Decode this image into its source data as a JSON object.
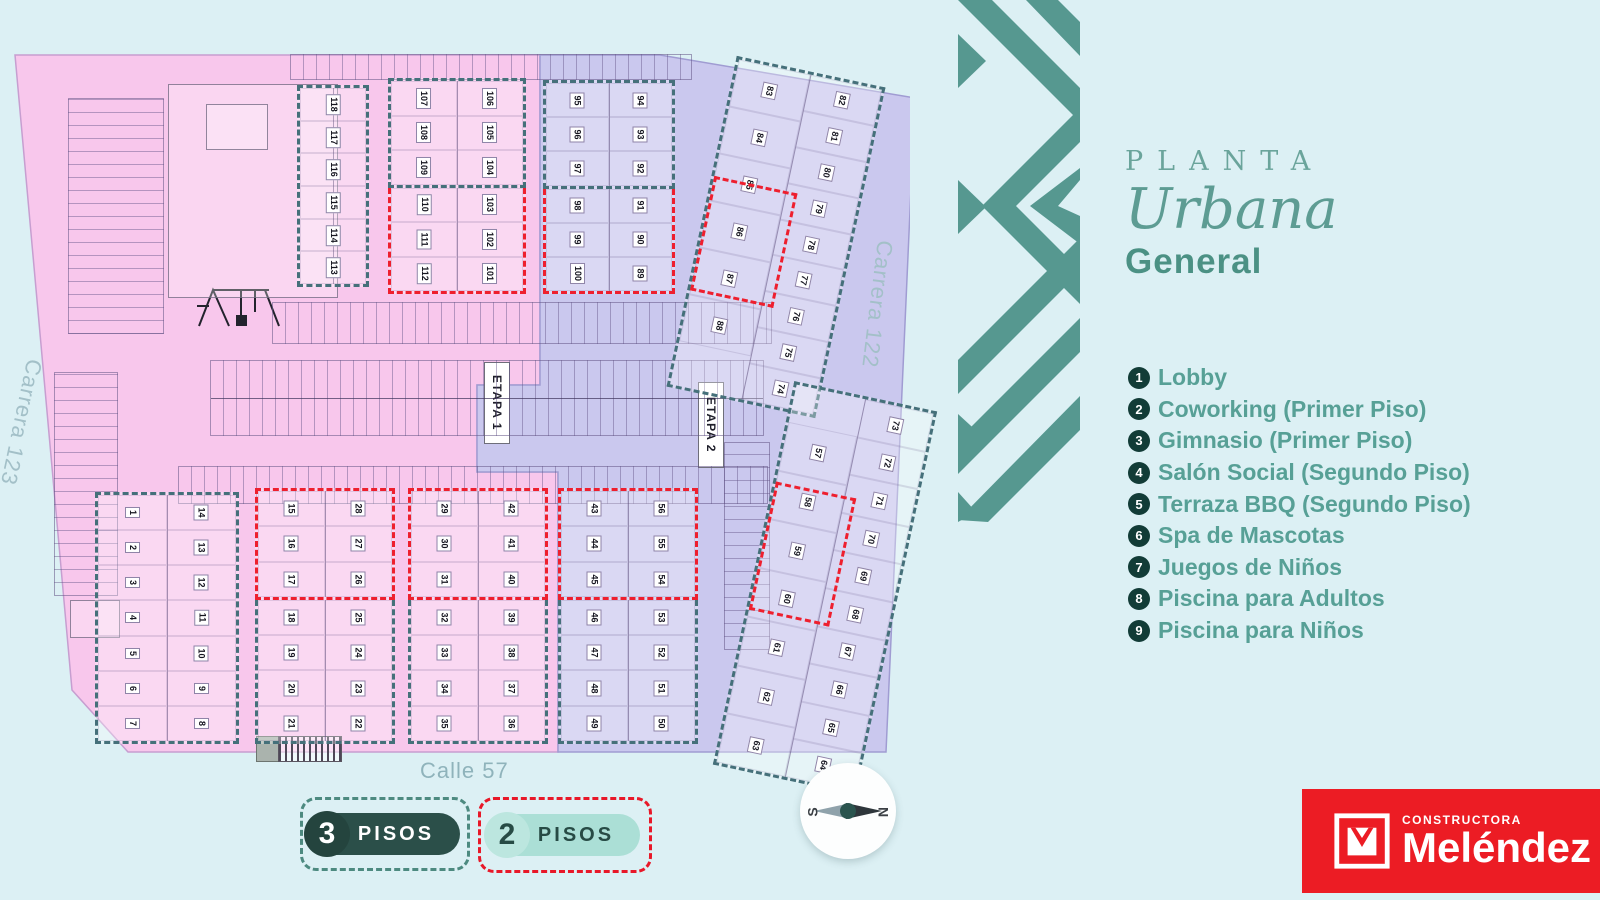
{
  "title": {
    "kicker": "PLANTA",
    "main": "Urbana",
    "sub": "General"
  },
  "amenities": [
    {
      "n": "1",
      "label": "Lobby"
    },
    {
      "n": "2",
      "label": "Coworking (Primer Piso)"
    },
    {
      "n": "3",
      "label": "Gimnasio (Primer Piso)"
    },
    {
      "n": "4",
      "label": "Salón Social (Segundo Piso)"
    },
    {
      "n": "5",
      "label": "Terraza BBQ (Segundo Piso)"
    },
    {
      "n": "6",
      "label": "Spa de Mascotas"
    },
    {
      "n": "7",
      "label": "Juegos de Niños"
    },
    {
      "n": "8",
      "label": "Piscina para Adultos"
    },
    {
      "n": "9",
      "label": "Piscina para Niños"
    }
  ],
  "streets": {
    "left": "Carrera 123",
    "right": "Carrera 122",
    "bottom": "Calle 57"
  },
  "etapas": {
    "e1": "ETAPA 1",
    "e2": "ETAPA 2"
  },
  "floor_legend": {
    "three": {
      "num": "3",
      "label": "PISOS"
    },
    "two": {
      "num": "2",
      "label": "PISOS"
    }
  },
  "compass": {
    "n": "N",
    "s": "S"
  },
  "brand": {
    "kicker": "CONSTRUCTORA",
    "name": "Meléndez"
  },
  "colors": {
    "background": "#dcf0f4",
    "etapa1_pink": "#f8c7ec",
    "etapa2_lavender": "#cac8ee",
    "teal_dash_3_pisos": "#45707a",
    "red_dash_2_pisos": "#ee1f2e",
    "brand_pattern_teal": "#569890",
    "title_teal": "#5d9c93",
    "legend_text_teal": "#57a096",
    "legend_circle_dark": "#123c37",
    "pill_dark": "#2b4f49",
    "pill_mint": "#abdfd6",
    "logo_red": "#ec1c24"
  },
  "map": {
    "blocks": [
      {
        "x": 287,
        "y": 45,
        "w": 72,
        "h": 202,
        "sections": [
          {
            "border": "teal",
            "cols": [
              [
                "118",
                "117",
                "116",
                "115",
                "114",
                "113"
              ]
            ]
          }
        ]
      },
      {
        "x": 378,
        "y": 38,
        "w": 138,
        "h": 216,
        "sections": [
          {
            "border": "teal",
            "cols": [
              [
                "107",
                "108",
                "109"
              ],
              [
                "106",
                "105",
                "104"
              ]
            ]
          },
          {
            "border": "red",
            "cols": [
              [
                "110",
                "111",
                "112"
              ],
              [
                "103",
                "102",
                "101"
              ]
            ]
          }
        ]
      },
      {
        "x": 533,
        "y": 40,
        "w": 132,
        "h": 214,
        "sections": [
          {
            "border": "teal",
            "cols": [
              [
                "95",
                "96",
                "97"
              ],
              [
                "94",
                "93",
                "92"
              ]
            ]
          },
          {
            "border": "red",
            "cols": [
              [
                "98",
                "99",
                "100"
              ],
              [
                "91",
                "90",
                "89"
              ]
            ]
          }
        ]
      },
      {
        "x": 690,
        "y": 28,
        "w": 152,
        "h": 338,
        "rot": 12,
        "sections": [
          {
            "border": "teal",
            "cols": [
              {
                "units": [
                  "83",
                  "84",
                  "85",
                  "86",
                  "87",
                  "88"
                ],
                "padBottom": "30%"
              },
              {
                "units": [
                  "82",
                  "81",
                  "80",
                  "79",
                  "78",
                  "77",
                  "76",
                  "75",
                  "74"
                ]
              }
            ]
          }
        ],
        "overlays": [
          {
            "border": "red",
            "x": "2%",
            "y": "36%",
            "w": "52%",
            "h": "33%"
          }
        ]
      },
      {
        "x": 85,
        "y": 452,
        "w": 144,
        "h": 252,
        "sections": [
          {
            "border": "teal",
            "cols": [
              [
                "1",
                "2",
                "3",
                "4",
                "5",
                "6",
                "7"
              ],
              [
                "14",
                "13",
                "12",
                "11",
                "10",
                "9",
                "8"
              ]
            ]
          }
        ]
      },
      {
        "x": 245,
        "y": 448,
        "w": 140,
        "h": 256,
        "sections": [
          {
            "border": "red",
            "cols": [
              [
                "15",
                "16",
                "17"
              ],
              [
                "28",
                "27",
                "26"
              ]
            ]
          },
          {
            "border": "teal",
            "cols": [
              [
                "18",
                "19",
                "20",
                "21"
              ],
              [
                "25",
                "24",
                "23",
                "22"
              ]
            ]
          }
        ]
      },
      {
        "x": 398,
        "y": 448,
        "w": 140,
        "h": 256,
        "sections": [
          {
            "border": "red",
            "cols": [
              [
                "29",
                "30",
                "31"
              ],
              [
                "42",
                "41",
                "40"
              ]
            ]
          },
          {
            "border": "teal",
            "cols": [
              [
                "32",
                "33",
                "34",
                "35"
              ],
              [
                "39",
                "38",
                "37",
                "36"
              ]
            ]
          }
        ]
      },
      {
        "x": 548,
        "y": 448,
        "w": 140,
        "h": 256,
        "sections": [
          {
            "border": "red",
            "cols": [
              [
                "43",
                "44",
                "45"
              ],
              [
                "56",
                "55",
                "54"
              ]
            ]
          },
          {
            "border": "teal",
            "cols": [
              [
                "46",
                "47",
                "48",
                "49"
              ],
              [
                "53",
                "52",
                "51",
                "50"
              ]
            ]
          }
        ]
      },
      {
        "x": 742,
        "y": 352,
        "w": 146,
        "h": 392,
        "rot": 12,
        "sections": [
          {
            "border": "teal",
            "cols": [
              {
                "units": [
                  "57",
                  "58",
                  "59",
                  "60",
                  "61",
                  "62",
                  "63"
                ],
                "padTop": "27%"
              },
              {
                "units": [
                  "73",
                  "72",
                  "71",
                  "70",
                  "69",
                  "68",
                  "67",
                  "66",
                  "65",
                  "64"
                ]
              }
            ]
          }
        ],
        "overlays": [
          {
            "border": "red",
            "x": "2%",
            "y": "26%",
            "w": "52%",
            "h": "32%"
          }
        ]
      }
    ],
    "strips": [
      {
        "x": 280,
        "y": 14,
        "w": 400,
        "h": 24,
        "dir": "h"
      },
      {
        "x": 262,
        "y": 262,
        "w": 498,
        "h": 40,
        "dir": "h"
      },
      {
        "x": 200,
        "y": 320,
        "w": 552,
        "h": 74,
        "dir": "h",
        "double": true
      },
      {
        "x": 168,
        "y": 426,
        "w": 588,
        "h": 36,
        "dir": "h"
      },
      {
        "x": 714,
        "y": 402,
        "w": 44,
        "h": 206,
        "dir": "v"
      },
      {
        "x": 58,
        "y": 58,
        "w": 94,
        "h": 234,
        "dir": "v"
      },
      {
        "x": 44,
        "y": 332,
        "w": 62,
        "h": 222,
        "dir": "v"
      }
    ],
    "sketches": [
      {
        "type": "outline",
        "x": 158,
        "y": 44,
        "w": 168,
        "h": 212
      },
      {
        "type": "outline",
        "x": 196,
        "y": 64,
        "w": 60,
        "h": 44
      },
      {
        "type": "outline",
        "x": 60,
        "y": 560,
        "w": 48,
        "h": 36
      },
      {
        "type": "fill",
        "x": 246,
        "y": 696,
        "w": 22,
        "h": 24
      },
      {
        "type": "hatch",
        "x": 268,
        "y": 696,
        "w": 62,
        "h": 24
      }
    ]
  }
}
